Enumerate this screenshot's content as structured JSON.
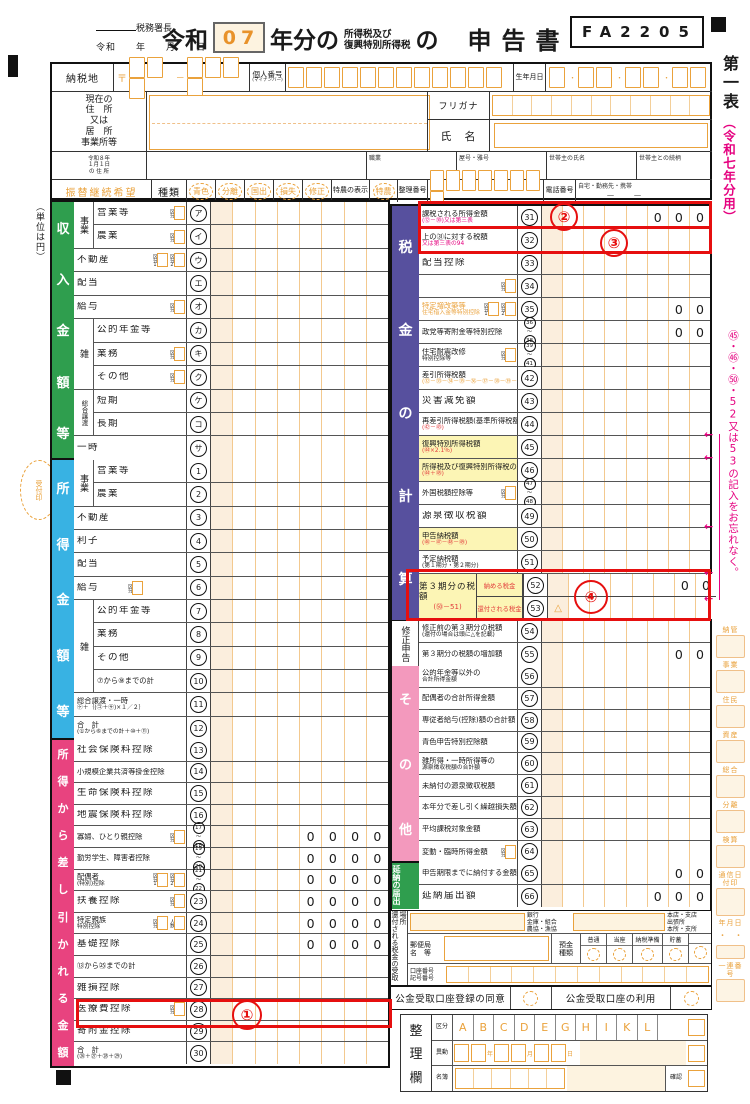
{
  "header": {
    "form_code": "FA2205",
    "tax_office": "税務署長",
    "date_line": "令和　　年　　月　　日",
    "title_era": "令和",
    "title_year": "07",
    "title_mid": "年分の",
    "title_sm1": "所得税及び",
    "title_sm2": "復興特別所得税",
    "title_no": "の",
    "title_end": "申告書"
  },
  "info": {
    "tax_place": "納税地",
    "postal_mark": "〒",
    "dash": "－",
    "personal_no": "個人番号",
    "personal_no_sub": "(マイナンバー)",
    "birth": "生年月日",
    "addr1": "現在の",
    "addr2": "住　所",
    "addr3": "又は",
    "addr4": "居　所",
    "addr5": "事業所等",
    "furigana": "フリガナ",
    "name": "氏　名",
    "jan1a": "令和８年",
    "jan1b": "１月１日",
    "jan1c": "の 住 所",
    "occupation": "職業",
    "shop": "屋号・雅号",
    "head": "世帯主の氏名",
    "rel": "世帯主との続柄",
    "furikae": "振替継続希望",
    "type_label": "種類",
    "types": [
      "青色",
      "分離",
      "国出",
      "損失",
      "修正"
    ],
    "tokuno_label": "特農の表示",
    "tokuno": "特農",
    "seiri_no": "整理番号",
    "tel": "電話番号",
    "tel_sub": "自宅・勤務先・携帯",
    "tel_dash": "－　　－"
  },
  "margin": {
    "unit": "（単位は円）",
    "uketsuke": "受付印",
    "sheet": "第一表",
    "sheet_note": "（令和七年分用）",
    "pink_note": "㊺・㊻・㊿・52又は53の記入をお忘れなく。"
  },
  "income": {
    "title": "収入金額等",
    "groups": [
      {
        "l": "事業",
        "from": 0,
        "span": 2
      },
      {
        "l": "雑",
        "from": 5,
        "span": 3
      },
      {
        "l": "総合譲渡",
        "from": 8,
        "span": 2
      }
    ],
    "rows": [
      {
        "l": "営業等",
        "k": "1",
        "n": "ア",
        "ind": 1
      },
      {
        "l": "農業",
        "k": "1",
        "n": "イ",
        "ind": 1
      },
      {
        "l": "不動産",
        "k": "12",
        "n": "ウ"
      },
      {
        "l": "配当",
        "n": "エ"
      },
      {
        "l": "給与",
        "k": "1",
        "n": "オ"
      },
      {
        "l": "公的年金等",
        "n": "カ",
        "ind": 1
      },
      {
        "l": "業務",
        "k": "1",
        "n": "キ",
        "ind": 1
      },
      {
        "l": "その他",
        "k": "1",
        "n": "ク",
        "ind": 1
      },
      {
        "l": "短期",
        "n": "ケ",
        "ind": 1
      },
      {
        "l": "長期",
        "n": "コ",
        "ind": 1
      },
      {
        "l": "一時",
        "n": "サ"
      }
    ]
  },
  "shotoku": {
    "title": "所得金額等",
    "groups": [
      {
        "l": "事業",
        "from": 0,
        "span": 2
      },
      {
        "l": "雑",
        "from": 6,
        "span": 4
      }
    ],
    "rows": [
      {
        "l": "営業等",
        "n": "1",
        "ind": 1
      },
      {
        "l": "農業",
        "n": "2",
        "ind": 1
      },
      {
        "l": "不動産",
        "n": "3"
      },
      {
        "l": "利子",
        "n": "4"
      },
      {
        "l": "配当",
        "n": "5"
      },
      {
        "l": "給与",
        "k": "g4",
        "n": "6"
      },
      {
        "l": "公的年金等",
        "n": "7",
        "ind": 1
      },
      {
        "l": "業務",
        "n": "8",
        "ind": 1
      },
      {
        "l": "その他",
        "n": "9",
        "ind": 1
      },
      {
        "l": "⑦から⑨までの計",
        "n": "10",
        "ind": 1,
        "s": 1
      },
      {
        "l": "総合譲渡・一時",
        "l2": "㋘＋｛(㋙＋㋚)×１／２｝",
        "n": "11",
        "s": 1
      },
      {
        "l": "合　計",
        "l2": "(①から⑥までの計＋⑩＋⑪)",
        "n": "12",
        "s": 1
      }
    ]
  },
  "deduction": {
    "title": "所得から差し引かれる金額",
    "groups": [],
    "rows": [
      {
        "l": "社会保険料控除",
        "n": "13"
      },
      {
        "l": "小規模企業共済等掛金控除",
        "n": "14",
        "s": 1
      },
      {
        "l": "生命保険料控除",
        "n": "15"
      },
      {
        "l": "地震保険料控除",
        "n": "16"
      },
      {
        "l": "寡婦、ひとり親控除",
        "k": "1",
        "n2": [
          "17",
          "18"
        ],
        "z": "0000",
        "s": 1
      },
      {
        "l": "勤労学生、障害者控除",
        "n2": [
          "19",
          "20"
        ],
        "z": "0000",
        "s": 1
      },
      {
        "l": "配偶者",
        "l2": "(特別)控除",
        "k": "12",
        "n2": [
          "21",
          "22"
        ],
        "z": "0000",
        "s": 1
      },
      {
        "l": "扶養控除",
        "k": "1",
        "n": "23",
        "z": "0000"
      },
      {
        "l": "特定親族",
        "l2": "特別控除",
        "k": "1n",
        "n": "24",
        "z": "0000",
        "s": 1
      },
      {
        "l": "基礎控除",
        "n": "25",
        "z": "0000"
      },
      {
        "l": "⑬から㉕までの計",
        "n": "26",
        "s": 1
      },
      {
        "l": "雑損控除",
        "n": "27"
      },
      {
        "l": "医療費控除",
        "k": "1",
        "n": "28"
      },
      {
        "l": "寄附金控除",
        "n": "29"
      },
      {
        "l": "合　計",
        "l2": "(㉖＋㉗＋㉘＋㉙)",
        "n": "30",
        "s": 1
      }
    ]
  },
  "tax": {
    "title": "税金の計算",
    "groups": [
      {
        "l": "修正申告",
        "from": 18,
        "span": 2,
        "bar": 1
      }
    ],
    "rows": [
      {
        "l": "課税される所得金額",
        "l2": "(⑫－㉚)又は第三表",
        "l2m": 1,
        "n": "31",
        "z": "000",
        "s": 1
      },
      {
        "l": "上の㉛に対する税額",
        "l2": "又は第三表の94",
        "l2m": 1,
        "n": "32",
        "s": 1
      },
      {
        "l": "配当控除",
        "n": "33"
      },
      {
        "l": "",
        "k": "1",
        "n": "34"
      },
      {
        "l": "特定増改築等",
        "l2": "住宅借入金等特別控除",
        "faint": 1,
        "k": "12",
        "n": "35",
        "z": "00",
        "s": 1
      },
      {
        "l": "政党等寄附金等特別控除",
        "n2": [
          "36",
          "38"
        ],
        "z": "00",
        "s": 1
      },
      {
        "l": "住宅耐震改修",
        "l2": "特別控除等",
        "k": "1",
        "n2": [
          "39",
          "41"
        ],
        "s": 1
      },
      {
        "l": "差引所得税額",
        "l2": "(㉜－㉝－㉞－㉟－㊱－㊲－㊳－㊴－㊵－㊶)",
        "l2f": 1,
        "n": "42",
        "s": 1
      },
      {
        "l": "災害減免額",
        "n": "43"
      },
      {
        "l": "再差引所得税額(基準所得税額)",
        "l2": "(㊷－㊸)",
        "l2r": 1,
        "n": "44",
        "s": 1
      },
      {
        "l": "復興特別所得税額",
        "l2": "(㊹×2.1％)",
        "l2r": 1,
        "y": 1,
        "n": "45",
        "s": 1
      },
      {
        "l": "所得税及び復興特別所得税の額",
        "l2": "(㊹＋㊺)",
        "l2r": 1,
        "y": 1,
        "n": "46",
        "s": 1
      },
      {
        "l": "外国税額控除等",
        "k": "1",
        "n2": [
          "47",
          "48"
        ],
        "s": 1
      },
      {
        "l": "源泉徴収税額",
        "n": "49"
      },
      {
        "l": "申告納税額",
        "l2": "(㊻－㊼－㊽－㊾)",
        "l2r": 1,
        "y": 1,
        "n": "50",
        "s": 1
      },
      {
        "l": "予定納税額",
        "l2": "(第１期分・第２期分)",
        "n": "51",
        "s": 1
      },
      {
        "pair": 1,
        "l": "第３期分の税額",
        "f": "(㊿－51)",
        "subs": [
          {
            "l": "納める税金",
            "n": "52",
            "z": "00"
          },
          {
            "l": "還付される税金",
            "n": "53",
            "tri": 1
          }
        ]
      },
      {
        "l": "修正前の第３期分の税額",
        "l2": "(還付の場合は頭に△を記載)",
        "n": "54",
        "s": 1
      },
      {
        "l": "第３期分の税額の増加額",
        "n": "55",
        "z": "00",
        "s": 1
      }
    ]
  },
  "other": {
    "title": "その他",
    "groups": [],
    "rows": [
      {
        "l": "公的年金等以外の",
        "l2": "合計所得金額",
        "n": "56",
        "s": 1
      },
      {
        "l": "配偶者の合計所得金額",
        "n": "57",
        "s": 1
      },
      {
        "l": "専従者給与(控除)額の合計額",
        "n": "58",
        "s": 1
      },
      {
        "l": "青色申告特別控除額",
        "n": "59",
        "s": 1
      },
      {
        "l": "雑所得・一時所得等の",
        "l2": "源泉徴収税額の合計額",
        "n": "60",
        "s": 1
      },
      {
        "l": "未納付の源泉徴収税額",
        "n": "61",
        "s": 1
      },
      {
        "l": "本年分で差し引く繰越損失額",
        "n": "62",
        "s": 1
      },
      {
        "l": "平均課税対象金額",
        "n": "63",
        "s": 1
      },
      {
        "l": "変動・臨時所得金額",
        "k": "1",
        "n": "64",
        "s": 1
      }
    ]
  },
  "ennou": {
    "title": "延納の届出",
    "groups": [],
    "rows": [
      {
        "l": "申告期限までに納付する金額",
        "n": "65",
        "z": "00",
        "s": 1
      },
      {
        "l": "延納届出額",
        "n": "66",
        "z": "000"
      }
    ]
  },
  "bank": {
    "refund_label": "還付される税金の受取場所",
    "bank_types": [
      "銀行",
      "金庫・組合",
      "農協・漁協"
    ],
    "branch_types": [
      "本店・支店",
      "出張所",
      "本所・支所"
    ],
    "post1": "郵便局",
    "post2": "名　等",
    "dep1": "預金",
    "dep2": "種類",
    "deposit_types": [
      "普通",
      "当座",
      "納税準備",
      "貯蓄"
    ],
    "acct1": "口座番号",
    "acct2": "記号番号"
  },
  "consent": {
    "agree": "公金受取口座登録の同意",
    "use": "公金受取口座の利用"
  },
  "seiri": {
    "label": "整理欄",
    "kubun": "区分",
    "letters": [
      "A",
      "B",
      "C",
      "D",
      "E",
      "G",
      "H",
      "I",
      "K",
      "L"
    ],
    "ido": "異動",
    "date_units": [
      "年",
      "月",
      "日"
    ],
    "meibo": "名簿",
    "kakunin": "確認"
  },
  "admin": {
    "items": [
      "納管",
      "事業",
      "住民",
      "資産",
      "総合",
      "分離",
      "検算",
      "通信日付印",
      "年月日",
      "一連番号"
    ],
    "dots": "・　・"
  },
  "annotations": {
    "a1": "①",
    "a2": "②",
    "a3": "③",
    "a4": "④"
  }
}
